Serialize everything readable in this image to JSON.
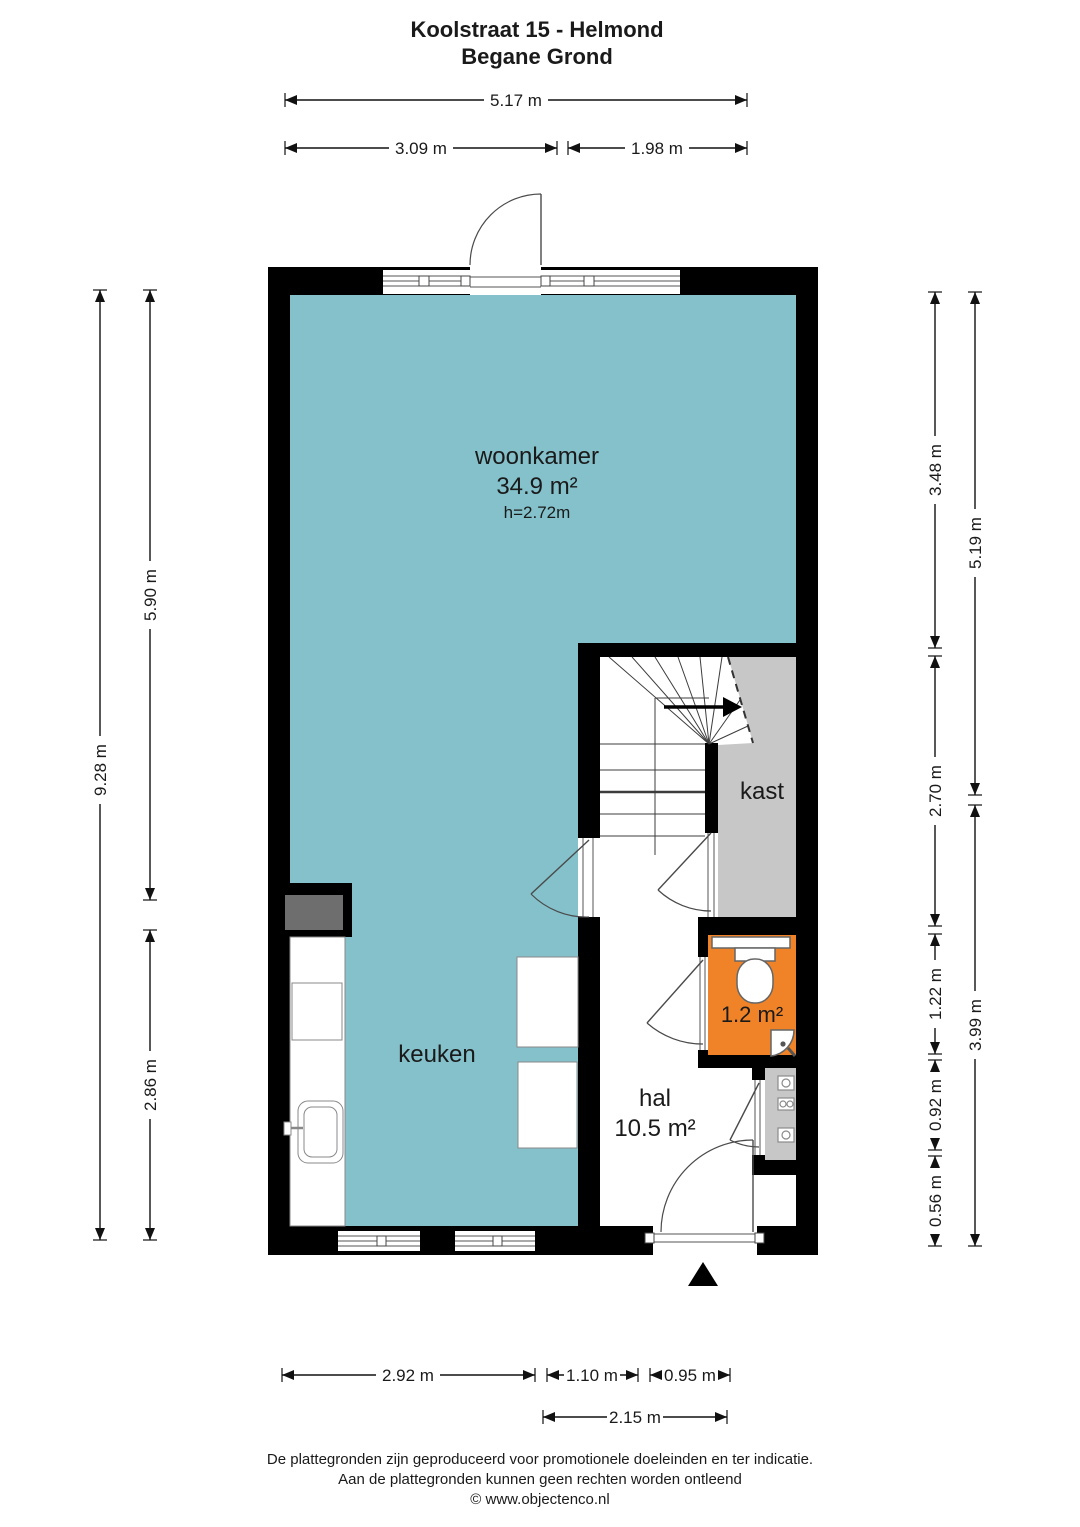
{
  "title": {
    "line1": "Koolstraat 15 - Helmond",
    "line2": "Begane Grond"
  },
  "rooms": {
    "woonkamer": {
      "label": "woonkamer",
      "area": "34.9 m²",
      "ceiling_height": "h=2.72m"
    },
    "keuken": {
      "label": "keuken"
    },
    "hal": {
      "label": "hal",
      "area": "10.5 m²"
    },
    "kast": {
      "label": "kast"
    },
    "toilet": {
      "area": "1.2 m²"
    }
  },
  "dimensions": {
    "top": {
      "total": "5.17 m",
      "left": "3.09 m",
      "right": "1.98 m"
    },
    "left": {
      "total": "9.28 m",
      "upper": "5.90 m",
      "lower": "2.86 m"
    },
    "right_inner": {
      "seg1": "3.48 m",
      "seg2": "2.70 m",
      "seg3": "1.22 m",
      "seg4": "0.92 m",
      "seg5": "0.56 m"
    },
    "right_outer": {
      "upper": "5.19 m",
      "lower": "3.99 m"
    },
    "bottom": {
      "seg1": "2.92 m",
      "seg2": "1.10 m",
      "seg3": "0.95 m",
      "total_hal": "2.15 m"
    }
  },
  "footer": {
    "line1": "De plattegronden zijn geproduceerd voor promotionele doeleinden en ter indicatie.",
    "line2": "Aan de plattegronden kunnen geen rechten worden ontleend",
    "line3": "© www.objectenco.nl"
  },
  "colors": {
    "living_fill": "#84c1cb",
    "closet_fill": "#c7c7c7",
    "toilet_fill": "#f08327",
    "duct_fill": "#6e6e6e",
    "wall": "#000000"
  }
}
